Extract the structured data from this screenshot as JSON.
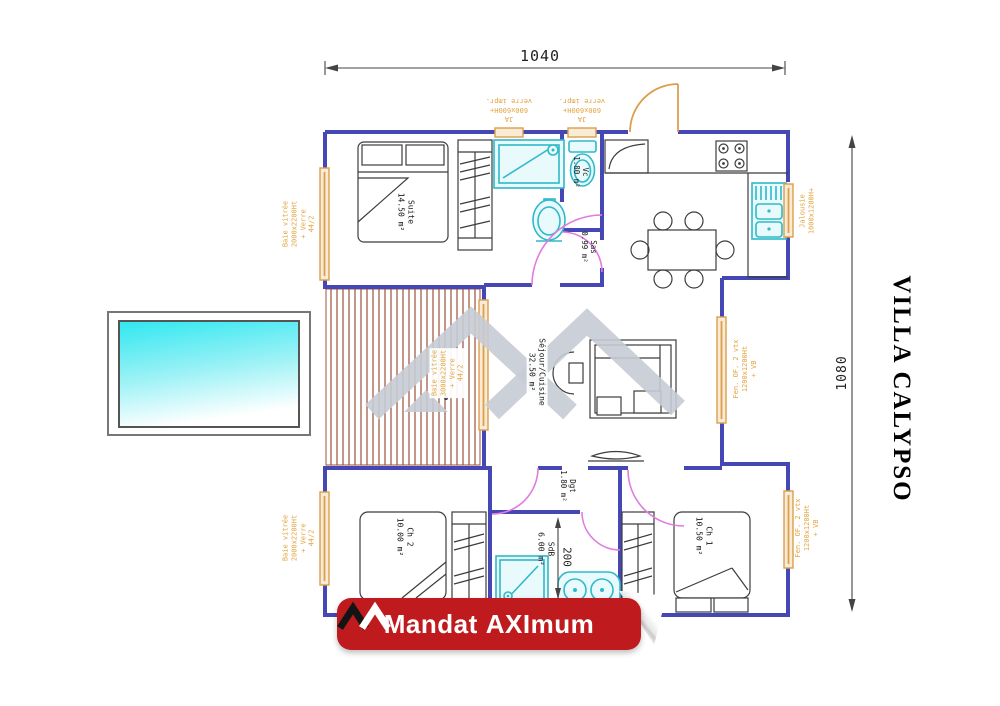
{
  "title": "VILLA CALYPSO",
  "dimensions": {
    "top": "1040",
    "right": "1080",
    "sdb": "200"
  },
  "rooms": {
    "suite": {
      "name": "Suite",
      "area": "14.50 m²"
    },
    "vc": {
      "name": "Vc",
      "area": "1.80 m²"
    },
    "sas": {
      "name": "Sas",
      "area": "0.99 m²"
    },
    "sejour": {
      "name": "Séjour/Cuisine",
      "area": "32.50 m²"
    },
    "ch2": {
      "name": "Ch 2",
      "area": "10.00 m²"
    },
    "sdb": {
      "name": "SdB",
      "area": "6.00 m²"
    },
    "ch1": {
      "name": "Ch 1",
      "area": "10.50 m²"
    },
    "dgt": {
      "name": "Dgt",
      "area": "1.80 m²"
    }
  },
  "windows": {
    "ja_top": {
      "lines": [
        "JA",
        "600x600H+",
        "verre impr."
      ]
    },
    "baie_left": {
      "lines": [
        "Baie vitrée",
        "2000x2200Ht",
        "+ Verre",
        "44/2"
      ]
    },
    "baie_deck": {
      "lines": [
        "Baie vitrée",
        "3000x2200Ht",
        "+ Verre",
        "44/2"
      ]
    },
    "jalousie": {
      "lines": [
        "Jalousie",
        "1000x1200H+"
      ]
    },
    "fen_of": {
      "lines": [
        "Fen. OF. 2 vtx",
        "1200x1200Ht",
        "+ VB"
      ]
    }
  },
  "logo": {
    "left": "Mandat",
    "right": "AXImum"
  },
  "colors": {
    "wall": "#4547b5",
    "window": "#dd9e4f",
    "window_fill": "#f8ecd4",
    "window_text": "#e0a43e",
    "door": "#e07ce0",
    "fixture": "#2fb9c9",
    "fixture_fill": "#e8fafc",
    "furniture": "#3c3c3c",
    "deck": "#9c5038",
    "pool_top": "#2fe7f0",
    "watermark": "#c6cbd5",
    "banner": "#bf1b1f",
    "dim": "#444444"
  }
}
